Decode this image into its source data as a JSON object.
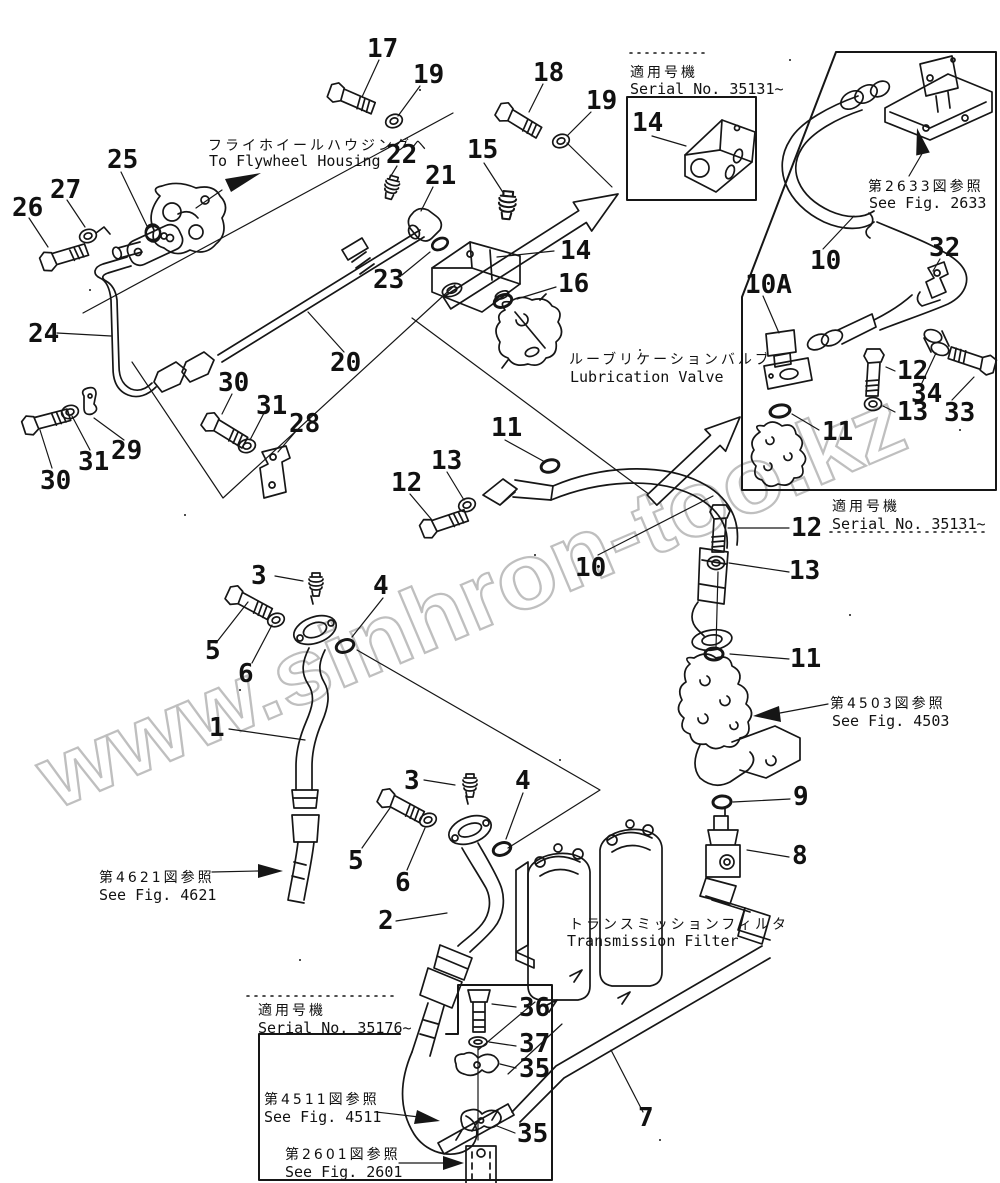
{
  "watermark": "www.sinhron-too.kz",
  "colors": {
    "line": "#161616",
    "watermark": "#b5b5b5",
    "background": "#ffffff"
  },
  "texts": {
    "flywheel_jp": "フライホイールハウジングヘ",
    "flywheel_en": "To Flywheel Housing",
    "lubrication_jp": "ルーブリケーションバルブ",
    "lubrication_en": "Lubrication Valve",
    "filter_jp": "トランスミッションフィルタ",
    "filter_en": "Transmission Filter",
    "serial_label_jp": "適用号機",
    "serial_top_jp": "適用号機",
    "serial_top_en": "Serial No. 35131~",
    "serial_right_jp": "適用号機",
    "serial_right_en": "Serial No. 35131~",
    "serial_bottom_jp": "適用号機",
    "serial_bottom_en": "Serial No. 35176~",
    "fig2633_jp": "第2633図参照",
    "fig2633_en": "See Fig. 2633",
    "fig4503_jp": "第4503図参照",
    "fig4503_en": "See Fig. 4503",
    "fig4621_jp": "第4621図参照",
    "fig4621_en": "See Fig. 4621",
    "fig4511_jp": "第4511図参照",
    "fig4511_en": "See Fig. 4511",
    "fig2601_jp": "第2601図参照",
    "fig2601_en": "See Fig. 2601"
  },
  "callouts": [
    {
      "n": "17",
      "x": 367,
      "y": 57
    },
    {
      "n": "19",
      "x": 413,
      "y": 83
    },
    {
      "n": "18",
      "x": 533,
      "y": 81
    },
    {
      "n": "19",
      "x": 586,
      "y": 109
    },
    {
      "n": "15",
      "x": 467,
      "y": 158
    },
    {
      "n": "25",
      "x": 107,
      "y": 168
    },
    {
      "n": "27",
      "x": 50,
      "y": 198
    },
    {
      "n": "26",
      "x": 12,
      "y": 216
    },
    {
      "n": "22",
      "x": 386,
      "y": 163
    },
    {
      "n": "21",
      "x": 425,
      "y": 184
    },
    {
      "n": "14",
      "x": 632,
      "y": 131
    },
    {
      "n": "23",
      "x": 373,
      "y": 288
    },
    {
      "n": "14",
      "x": 560,
      "y": 259
    },
    {
      "n": "16",
      "x": 558,
      "y": 292
    },
    {
      "n": "24",
      "x": 28,
      "y": 342
    },
    {
      "n": "20",
      "x": 330,
      "y": 371
    },
    {
      "n": "30",
      "x": 40,
      "y": 489
    },
    {
      "n": "31",
      "x": 78,
      "y": 470
    },
    {
      "n": "29",
      "x": 111,
      "y": 459
    },
    {
      "n": "30",
      "x": 218,
      "y": 391
    },
    {
      "n": "31",
      "x": 256,
      "y": 414
    },
    {
      "n": "28",
      "x": 289,
      "y": 432
    },
    {
      "n": "12",
      "x": 391,
      "y": 491
    },
    {
      "n": "13",
      "x": 431,
      "y": 469
    },
    {
      "n": "11",
      "x": 491,
      "y": 436
    },
    {
      "n": "10",
      "x": 575,
      "y": 576
    },
    {
      "n": "10",
      "x": 810,
      "y": 269
    },
    {
      "n": "32",
      "x": 929,
      "y": 256
    },
    {
      "n": "10A",
      "x": 745,
      "y": 293
    },
    {
      "n": "12",
      "x": 897,
      "y": 379
    },
    {
      "n": "34",
      "x": 911,
      "y": 402
    },
    {
      "n": "13",
      "x": 897,
      "y": 420
    },
    {
      "n": "33",
      "x": 944,
      "y": 421
    },
    {
      "n": "11",
      "x": 822,
      "y": 440
    },
    {
      "n": "12",
      "x": 791,
      "y": 536
    },
    {
      "n": "13",
      "x": 789,
      "y": 579
    },
    {
      "n": "11",
      "x": 790,
      "y": 667
    },
    {
      "n": "9",
      "x": 793,
      "y": 805
    },
    {
      "n": "8",
      "x": 792,
      "y": 864
    },
    {
      "n": "3",
      "x": 251,
      "y": 584
    },
    {
      "n": "4",
      "x": 373,
      "y": 594
    },
    {
      "n": "5",
      "x": 205,
      "y": 659
    },
    {
      "n": "6",
      "x": 238,
      "y": 682
    },
    {
      "n": "1",
      "x": 209,
      "y": 736
    },
    {
      "n": "3",
      "x": 404,
      "y": 789
    },
    {
      "n": "4",
      "x": 515,
      "y": 789
    },
    {
      "n": "5",
      "x": 348,
      "y": 869
    },
    {
      "n": "6",
      "x": 395,
      "y": 891
    },
    {
      "n": "2",
      "x": 378,
      "y": 929
    },
    {
      "n": "7",
      "x": 638,
      "y": 1126
    },
    {
      "n": "36",
      "x": 519,
      "y": 1016
    },
    {
      "n": "37",
      "x": 519,
      "y": 1052
    },
    {
      "n": "35",
      "x": 519,
      "y": 1077
    },
    {
      "n": "35",
      "x": 517,
      "y": 1142
    }
  ]
}
